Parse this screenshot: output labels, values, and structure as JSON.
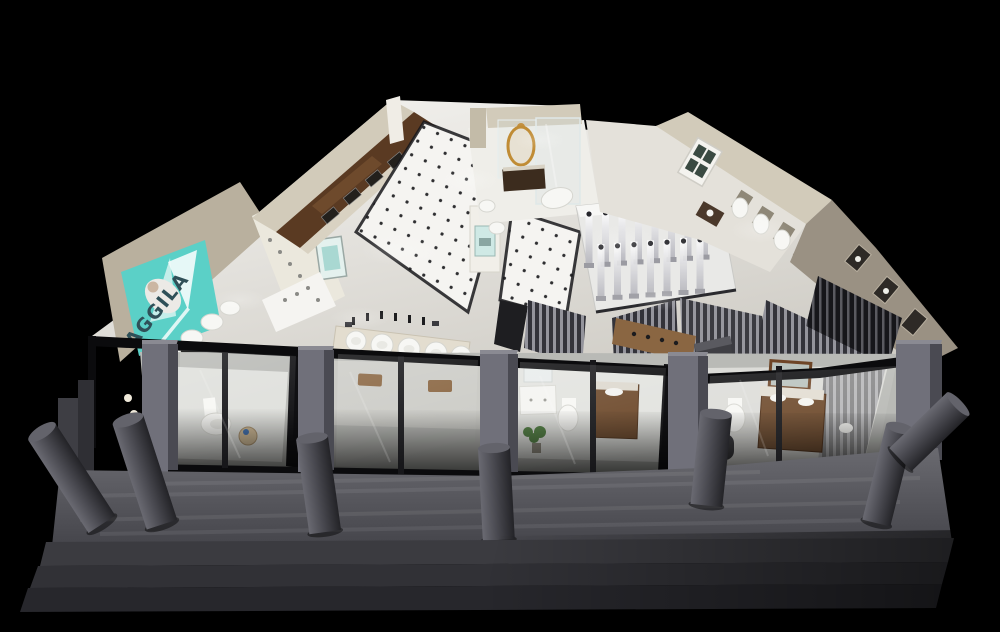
{
  "scene": {
    "title": "AGGILA sanitary-ware showroom — aerial cutaway 3D render at night",
    "view": "isometric bird's-eye cutaway",
    "background": "#000000"
  },
  "sign": {
    "brand": "AGGILA"
  },
  "palette": {
    "background": "#000000",
    "floor": "#e9e7e2",
    "floor_bright": "#f5f4f1",
    "wall": "#b9b09e",
    "wall_light": "#d2cbba",
    "wood": "#5a3a22",
    "wood_mid": "#6e4a2c",
    "wood_warm": "#8a6642",
    "gold": "#c39040",
    "ceramic": "#f7f7f4",
    "glass_frame": "#0b0b0d",
    "mullion": "#17171a",
    "pillar": "#70707a",
    "pillar_side": "#4a4a52",
    "pillar_top": "#8a8a92",
    "walkway": "#5c5c62",
    "step_1": "#3b3b40",
    "step_2": "#313136",
    "step_3": "#27272c",
    "plant_green": "#4a7a3a",
    "sign_panel": "#5bd0c7",
    "sign_text": "#2f5058",
    "slat_light": "#94949c",
    "slat_dark": "#33333a",
    "tile_dot": "#2f2f31"
  },
  "areas": [
    {
      "id": "entry-steps",
      "label": "entrance steps"
    },
    {
      "id": "front-walkway",
      "label": "front walkway with round bollards"
    },
    {
      "id": "storefront",
      "label": "black-framed glass storefront with grey piers"
    },
    {
      "id": "vignette-rooms",
      "label": "bathroom vignette rooms behind glass"
    },
    {
      "id": "brand-billboard",
      "label": "teal AGGILA billboard"
    },
    {
      "id": "toilet-display",
      "label": "toilet display row"
    },
    {
      "id": "wood-cabinet-wall",
      "label": "dark wood vanity / sink cabinet wall"
    },
    {
      "id": "dotted-tile-aisle",
      "label": "white dotted-tile aisle"
    },
    {
      "id": "basin-tables",
      "label": "basin and faucet display tables"
    },
    {
      "id": "classic-bath",
      "label": "classic vignette with gold mirror and tub"
    },
    {
      "id": "shower-display",
      "label": "shower-column display platform"
    },
    {
      "id": "right-wing",
      "label": "right wing with wall-hung toilets and window"
    },
    {
      "id": "slat-partitions",
      "label": "vertical slat partitions"
    }
  ]
}
